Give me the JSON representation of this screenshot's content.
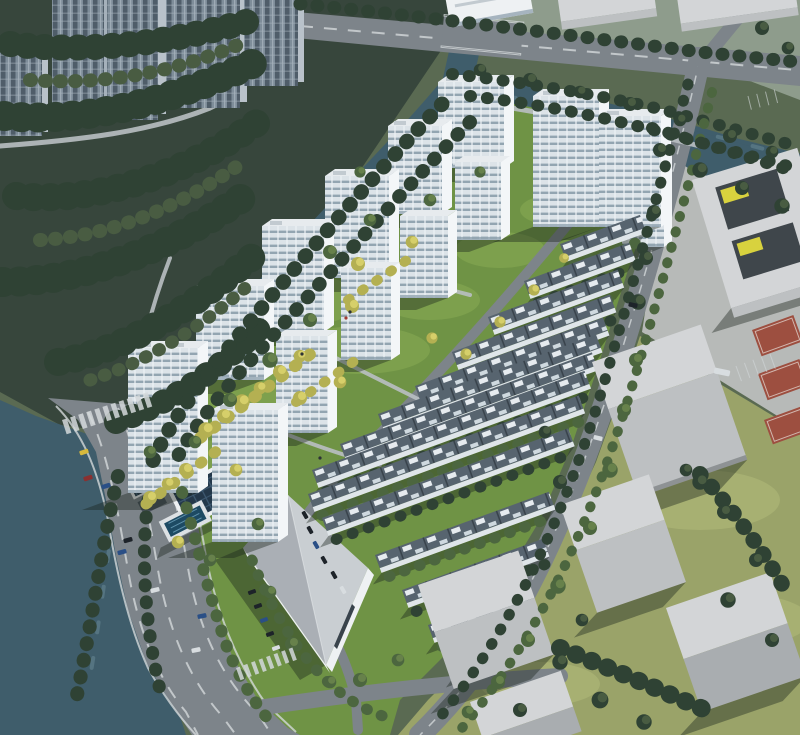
{
  "meta": {
    "description": "Bird's-eye 3D architectural rendering of a riverside residential development: white high-rise apartment towers and diagonal rows of low-rise townhouses set in bright landscaped gardens, bounded by a winding dark river with tree-lined banks, a wide arterial road at lower left, and pale schematic city blocks with basketball courts to the east.",
    "image_type": "aerial masterplan rendering",
    "visible_text": []
  },
  "scene": {
    "counts": {
      "development_towers": 14,
      "townhouse_rows": 14,
      "context_towers_top_left": 4,
      "context_massing_blocks": 8,
      "basketball_courts": 4,
      "road_bridges": 2,
      "cars_on_roads": 10
    },
    "features": [
      "river",
      "pond",
      "dense-forest",
      "arterial-road",
      "boulevard",
      "estate-road",
      "clubhouse-with-solar-roof",
      "swimming-pool",
      "sales-center-hall",
      "basketball-courts",
      "parking-rows",
      "crosswalks",
      "street-trees",
      "yellow-accent-landscaping"
    ]
  },
  "colors": {
    "bg": "#5a6a52",
    "north-ground": "#8e9c8c",
    "forest": "#37463c",
    "forest-hi": "#495c42",
    "lawn": "#6f9345",
    "lawn-hi": "#8fb257",
    "east-pave": "#b7bab8",
    "east-grass": "#9aa369",
    "east-grass-hi": "#b3bd7c",
    "river": "#3f5d6b",
    "river-hi": "#7fa0ab",
    "road": "#7d848a",
    "lane": "#d3d8da",
    "path": "#b9bfc2",
    "tw-face": "#dce3e8",
    "tw-band": "#93a5b1",
    "tw-mullion": "#eef2f5",
    "tw-side": "#f3f6f8",
    "tw-roof": "#e7ebee",
    "tw-box": "#c2cad0",
    "cw-base": "#7e8d99",
    "cw-dark": "#4f5d69",
    "cw-light": "#a5b1bb",
    "cw-side": "#b9c2ca",
    "row-roof": "#57646f",
    "row-panel": "#e6ebef",
    "row-panel2": "#cfd9df",
    "row-div": "#39434c",
    "row-wall": "#dfe5e9",
    "block-top": "#d3d5d7",
    "block-wall": "#bdc0c2",
    "block-wall2": "#a9adb0",
    "block-base": "#8e9294",
    "hall-roof": "#c9ced2",
    "wall-white": "#eef1f3",
    "court": "#9d4f40",
    "court-line": "#e8e3dd",
    "pv": "#24384a",
    "pv-line": "#3e5a72",
    "pool": "#1d4a63",
    "pool-lane": "#6fa3bd",
    "accent-yellow": "#d8d23e",
    "courtyard-dark": "#3f464b",
    "tree-dark": "#2f4234",
    "tree-mid": "#4c663f",
    "tree-mid-hi": "#67814b",
    "tree-yellow": "#b4b052",
    "tree-yellow-hi": "#d6cf6a",
    "shadow": "rgba(25,36,28,0.40)",
    "car-blue": "#2a4f86",
    "car-red": "#8a3030",
    "car-dark": "#1d2329",
    "car-white": "#d8dde0",
    "car-taxi": "#d7b93c"
  }
}
